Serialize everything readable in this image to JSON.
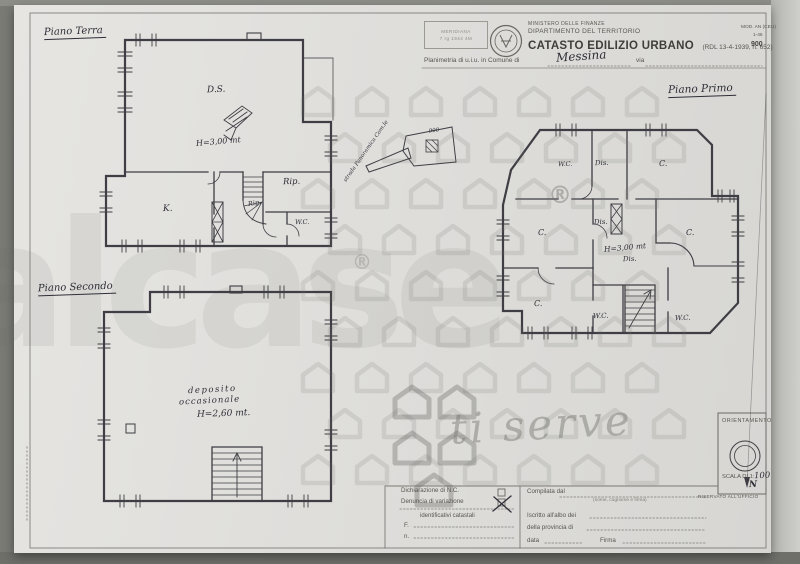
{
  "header": {
    "stamp_line1": "MERIDIANA",
    "stamp_line2": "7 rg 1944 4M",
    "ministry_line1": "MINISTERO DELLE FINANZE",
    "ministry_line2": "DIPARTIMENTO DEL TERRITORIO",
    "title": "CATASTO EDILIZIO URBANO",
    "title_suffix": "(RDL 13-4-1939, n. 652)",
    "planimetria_prefix": "Planimetria di u.i.u. in Comune di",
    "comune_value": "Messina",
    "via_label": "via",
    "mod_label": "MOD. AN (CEU)",
    "mod_sub": "1-46",
    "mod_number": "900"
  },
  "plans": {
    "ground": {
      "title": "Piano Terra",
      "labels": {
        "ds": "D.S.",
        "height": "H=3,00 mt",
        "k": "K.",
        "rip": "Rip.",
        "rip_small": "Rip.",
        "wc": "W.C."
      }
    },
    "second": {
      "title": "Piano Secondo",
      "labels": {
        "line1": "deposito",
        "line2": "occasionale",
        "height": "H=2,60 mt."
      }
    },
    "first": {
      "title": "Piano Primo",
      "labels": {
        "wc1": "W.C.",
        "dis1": "Dis.",
        "c1": "C.",
        "c2": "C.",
        "dis2": "Dis.",
        "height": "H=3,00 mt",
        "dis3": "Dis.",
        "c3": "C.",
        "c4": "C.",
        "wc2": "W.C.",
        "wc3": "W.C."
      }
    },
    "annotation": {
      "road": "strada Panoramica Com.le",
      "flag_number": "900"
    }
  },
  "form": {
    "left": {
      "row1": "Dichiarazione di N.C.",
      "row2": "Denuncia di variazione",
      "ident_title": "identificativi catastali",
      "f_label": "F.",
      "n_label": "n."
    },
    "right": {
      "compilata": "Compilata dal",
      "compilata_sub": "(nome, cognome e firma)",
      "iscritto": "Iscritto all'albo dei",
      "provincia": "della provincia di",
      "data_label": "data",
      "firma": "Firma"
    }
  },
  "orientation": {
    "title": "ORIENTAMENTO",
    "scale_label": "SCALA DI 1:",
    "scale_value": "100",
    "north": "N",
    "reserved": "RISERVATO ALL'UFFICIO"
  },
  "watermark": {
    "brand": "italcase",
    "registered": "®",
    "tagline": "ti serve",
    "color": "#c4c4c2"
  },
  "colors": {
    "ink": "#3e3e44",
    "handwriting": "#2e2f37",
    "paper": "#e0dfdc"
  }
}
